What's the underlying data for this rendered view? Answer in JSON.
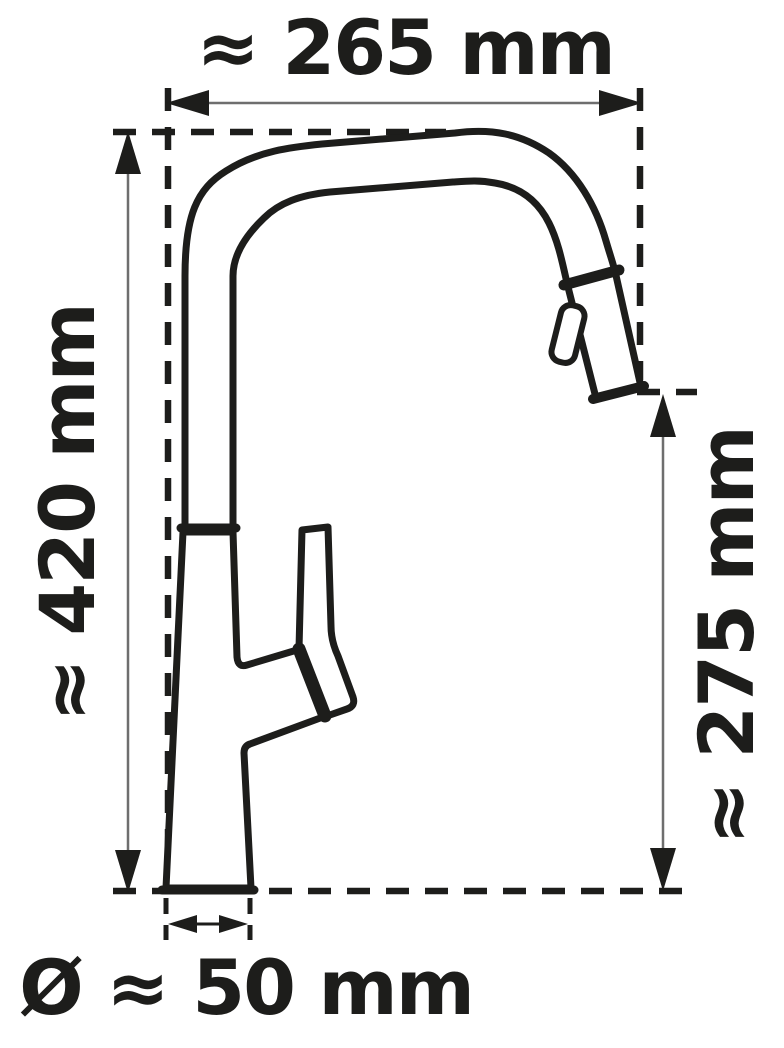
{
  "page": {
    "background": "#ffffff",
    "ink_color": "#1d1d1b",
    "dim_line_color": "#6e6e6e"
  },
  "diagram": {
    "type": "technical-dimension-drawing",
    "subject": "kitchen faucet (side view) with high-arc spout, pull-out spray head and side lever, dashed reference box and dimension arrows",
    "dimensions": {
      "overall_width": {
        "label": "≈ 265 mm",
        "value": 265,
        "unit": "mm",
        "approx": true,
        "position": "top"
      },
      "overall_height": {
        "label": "≈ 420 mm",
        "value": 420,
        "unit": "mm",
        "approx": true,
        "position": "left"
      },
      "outlet_height": {
        "label": "≈ 275 mm",
        "value": 275,
        "unit": "mm",
        "approx": true,
        "position": "right"
      },
      "base_diameter": {
        "label": "Ø ≈ 50 mm",
        "value": 50,
        "unit": "mm",
        "approx": true,
        "diameter": true,
        "position": "bottom"
      }
    }
  }
}
